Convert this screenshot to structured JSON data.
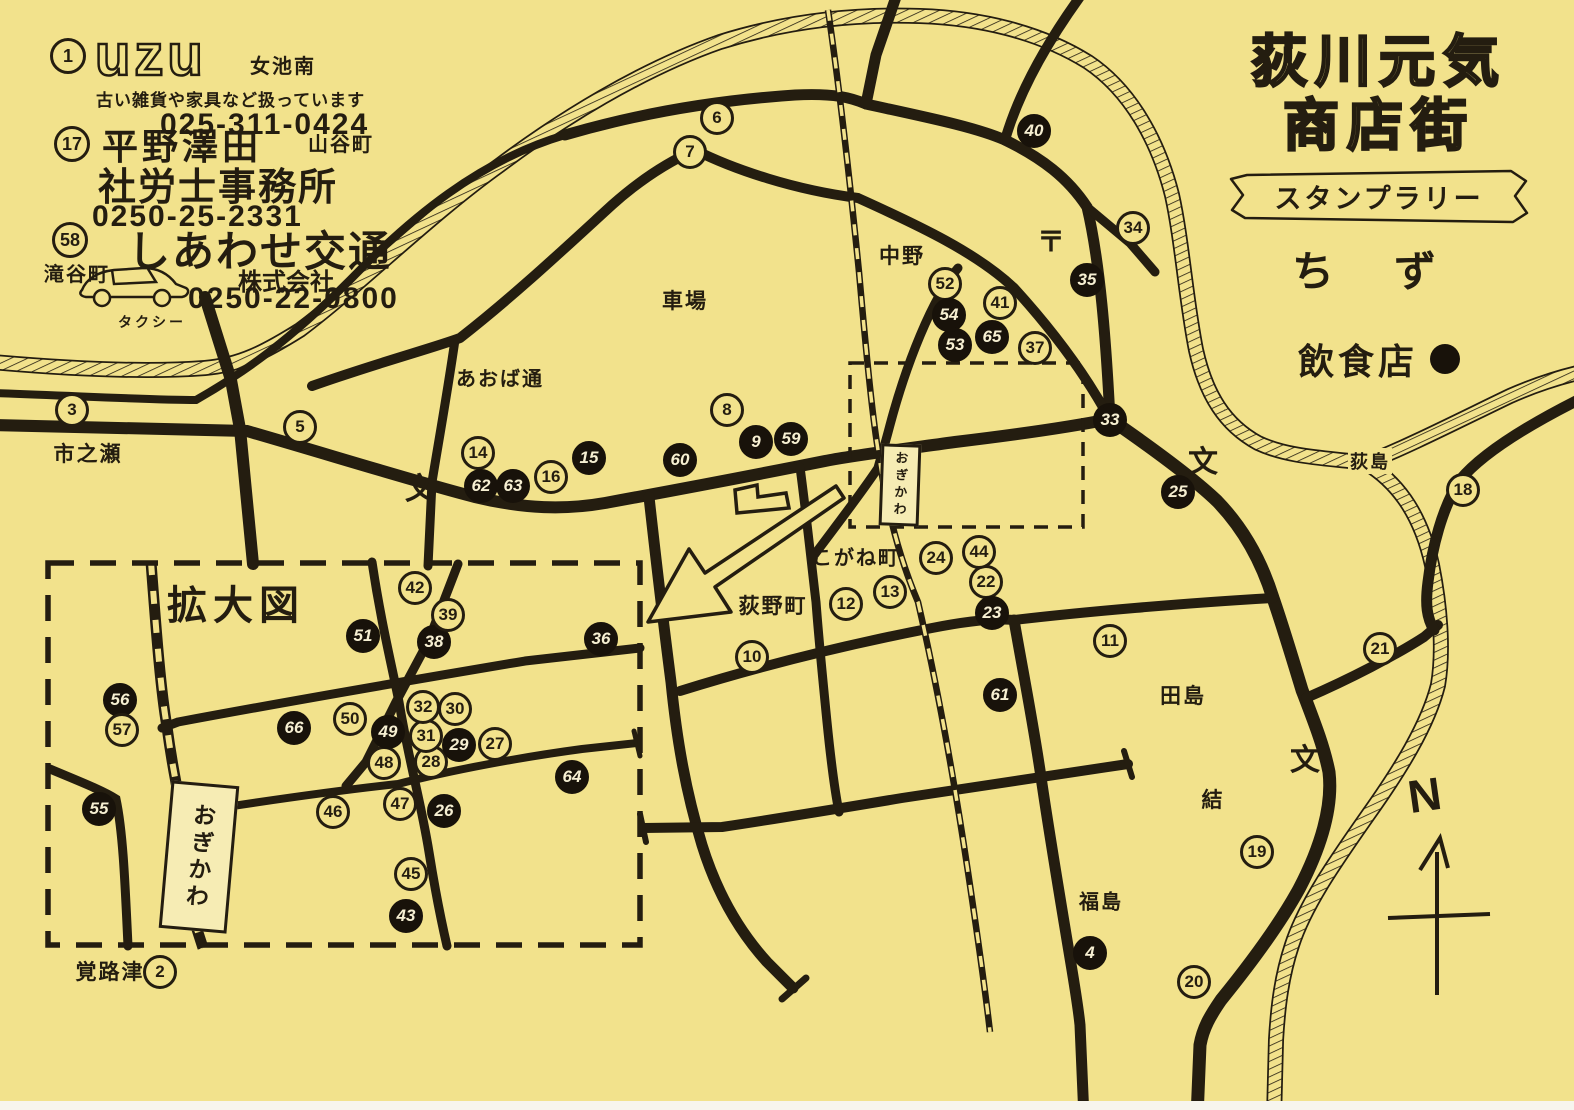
{
  "title": {
    "line1": "荻川元気",
    "line2": "商店街",
    "banner": "スタンプラリー",
    "chizu": "ちず"
  },
  "legend": {
    "label": "飲食店",
    "marker": "filled-circle"
  },
  "ads": [
    {
      "number": "1",
      "logo": "uzu",
      "area": "女池南",
      "desc": "古い雑貨や家具など扱っています",
      "phone": "025-311-0424"
    },
    {
      "number": "17",
      "name": "平野澤田",
      "name2": "社労士事務所",
      "area": "山谷町",
      "phone": "0250-25-2331"
    },
    {
      "number": "58",
      "area": "滝谷町",
      "name": "しあわせ交通",
      "suffix": "株式会社",
      "note": "タクシー",
      "phone": "0250-22-0800"
    }
  ],
  "inset_label": "拡大図",
  "station": {
    "name": "おぎかわ",
    "signs": [
      {
        "x": 897,
        "y": 482,
        "w": 34,
        "h": 76,
        "s": 13,
        "r": 2
      },
      {
        "x": 196,
        "y": 854,
        "w": 62,
        "h": 142,
        "s": 23,
        "r": 5
      }
    ]
  },
  "compass": {
    "letter": "N"
  },
  "labels": [
    {
      "text": "市之瀬",
      "x": 88,
      "y": 453,
      "s": 21
    },
    {
      "text": "あおば通",
      "x": 500,
      "y": 377,
      "s": 20
    },
    {
      "text": "車場",
      "x": 685,
      "y": 300,
      "s": 21
    },
    {
      "text": "中野",
      "x": 902,
      "y": 255,
      "s": 21
    },
    {
      "text": "〒",
      "x": 1052,
      "y": 240,
      "s": 28,
      "n": "post-office-symbol"
    },
    {
      "text": "こがね町",
      "x": 856,
      "y": 556,
      "s": 20
    },
    {
      "text": "荻野町",
      "x": 773,
      "y": 605,
      "s": 21
    },
    {
      "text": "田島",
      "x": 1183,
      "y": 695,
      "s": 21
    },
    {
      "text": "結",
      "x": 1213,
      "y": 799,
      "s": 21
    },
    {
      "text": "福島",
      "x": 1101,
      "y": 900,
      "s": 20
    },
    {
      "text": "覚路津",
      "x": 110,
      "y": 971,
      "s": 21
    },
    {
      "text": "荻島",
      "x": 1370,
      "y": 461,
      "s": 18,
      "bg": 1
    },
    {
      "text": "拡大図",
      "x": 236,
      "y": 602,
      "s": 40,
      "b": 1,
      "n": "inset-title"
    },
    {
      "text": "文",
      "x": 423,
      "y": 486,
      "s": 30,
      "b": 1,
      "n": "school-symbol"
    },
    {
      "text": "文",
      "x": 1206,
      "y": 459,
      "s": 30,
      "b": 1,
      "n": "school-symbol"
    },
    {
      "text": "文",
      "x": 1308,
      "y": 757,
      "s": 30,
      "b": 1,
      "n": "school-symbol"
    }
  ],
  "stamps": [
    {
      "n": 2,
      "x": 160,
      "y": 972,
      "f": 0
    },
    {
      "n": 3,
      "x": 72,
      "y": 410,
      "f": 0
    },
    {
      "n": 4,
      "x": 1090,
      "y": 953,
      "f": 1
    },
    {
      "n": 5,
      "x": 300,
      "y": 427,
      "f": 0
    },
    {
      "n": 6,
      "x": 717,
      "y": 118,
      "f": 0
    },
    {
      "n": 7,
      "x": 690,
      "y": 152,
      "f": 0
    },
    {
      "n": 8,
      "x": 727,
      "y": 410,
      "f": 0
    },
    {
      "n": 9,
      "x": 756,
      "y": 442,
      "f": 1
    },
    {
      "n": 10,
      "x": 752,
      "y": 657,
      "f": 0
    },
    {
      "n": 11,
      "x": 1110,
      "y": 641,
      "f": 0
    },
    {
      "n": 12,
      "x": 846,
      "y": 604,
      "f": 0
    },
    {
      "n": 13,
      "x": 890,
      "y": 592,
      "f": 0
    },
    {
      "n": 14,
      "x": 478,
      "y": 453,
      "f": 0
    },
    {
      "n": 15,
      "x": 589,
      "y": 458,
      "f": 1
    },
    {
      "n": 16,
      "x": 551,
      "y": 477,
      "f": 0
    },
    {
      "n": 18,
      "x": 1463,
      "y": 490,
      "f": 0
    },
    {
      "n": 19,
      "x": 1257,
      "y": 852,
      "f": 0
    },
    {
      "n": 20,
      "x": 1194,
      "y": 982,
      "f": 0
    },
    {
      "n": 21,
      "x": 1380,
      "y": 649,
      "f": 0
    },
    {
      "n": 22,
      "x": 986,
      "y": 582,
      "f": 0
    },
    {
      "n": 23,
      "x": 992,
      "y": 613,
      "f": 1
    },
    {
      "n": 24,
      "x": 936,
      "y": 558,
      "f": 0
    },
    {
      "n": 25,
      "x": 1178,
      "y": 492,
      "f": 1
    },
    {
      "n": 26,
      "x": 444,
      "y": 811,
      "f": 1
    },
    {
      "n": 27,
      "x": 495,
      "y": 744,
      "f": 0
    },
    {
      "n": 28,
      "x": 431,
      "y": 762,
      "f": 0
    },
    {
      "n": 29,
      "x": 459,
      "y": 745,
      "f": 1
    },
    {
      "n": 30,
      "x": 455,
      "y": 709,
      "f": 0
    },
    {
      "n": 31,
      "x": 426,
      "y": 736,
      "f": 0
    },
    {
      "n": 32,
      "x": 423,
      "y": 707,
      "f": 0
    },
    {
      "n": 33,
      "x": 1110,
      "y": 420,
      "f": 1
    },
    {
      "n": 34,
      "x": 1133,
      "y": 228,
      "f": 0
    },
    {
      "n": 35,
      "x": 1087,
      "y": 280,
      "f": 1
    },
    {
      "n": 36,
      "x": 601,
      "y": 639,
      "f": 1
    },
    {
      "n": 37,
      "x": 1035,
      "y": 348,
      "f": 0
    },
    {
      "n": 38,
      "x": 434,
      "y": 642,
      "f": 1
    },
    {
      "n": 39,
      "x": 448,
      "y": 615,
      "f": 0
    },
    {
      "n": 40,
      "x": 1034,
      "y": 131,
      "f": 1
    },
    {
      "n": 41,
      "x": 1000,
      "y": 303,
      "f": 0
    },
    {
      "n": 42,
      "x": 415,
      "y": 588,
      "f": 0
    },
    {
      "n": 43,
      "x": 406,
      "y": 916,
      "f": 1
    },
    {
      "n": 44,
      "x": 979,
      "y": 552,
      "f": 0
    },
    {
      "n": 45,
      "x": 411,
      "y": 874,
      "f": 0
    },
    {
      "n": 46,
      "x": 333,
      "y": 812,
      "f": 0
    },
    {
      "n": 47,
      "x": 400,
      "y": 804,
      "f": 0
    },
    {
      "n": 48,
      "x": 384,
      "y": 763,
      "f": 0
    },
    {
      "n": 49,
      "x": 388,
      "y": 732,
      "f": 1
    },
    {
      "n": 50,
      "x": 350,
      "y": 719,
      "f": 0
    },
    {
      "n": 51,
      "x": 363,
      "y": 636,
      "f": 1
    },
    {
      "n": 52,
      "x": 945,
      "y": 284,
      "f": 0
    },
    {
      "n": 53,
      "x": 955,
      "y": 345,
      "f": 1
    },
    {
      "n": 54,
      "x": 949,
      "y": 315,
      "f": 1
    },
    {
      "n": 55,
      "x": 99,
      "y": 809,
      "f": 1
    },
    {
      "n": 56,
      "x": 120,
      "y": 700,
      "f": 1
    },
    {
      "n": 57,
      "x": 122,
      "y": 730,
      "f": 0
    },
    {
      "n": 59,
      "x": 791,
      "y": 439,
      "f": 1
    },
    {
      "n": 60,
      "x": 680,
      "y": 460,
      "f": 1
    },
    {
      "n": 61,
      "x": 1000,
      "y": 695,
      "f": 1
    },
    {
      "n": 62,
      "x": 481,
      "y": 486,
      "f": 1
    },
    {
      "n": 63,
      "x": 513,
      "y": 486,
      "f": 1
    },
    {
      "n": 64,
      "x": 572,
      "y": 777,
      "f": 1
    },
    {
      "n": 65,
      "x": 992,
      "y": 337,
      "f": 1
    },
    {
      "n": 66,
      "x": 294,
      "y": 728,
      "f": 1
    }
  ],
  "colors": {
    "paper": "#f2e28c",
    "ink": "#241d10",
    "stamp_fill": "#18120a"
  }
}
